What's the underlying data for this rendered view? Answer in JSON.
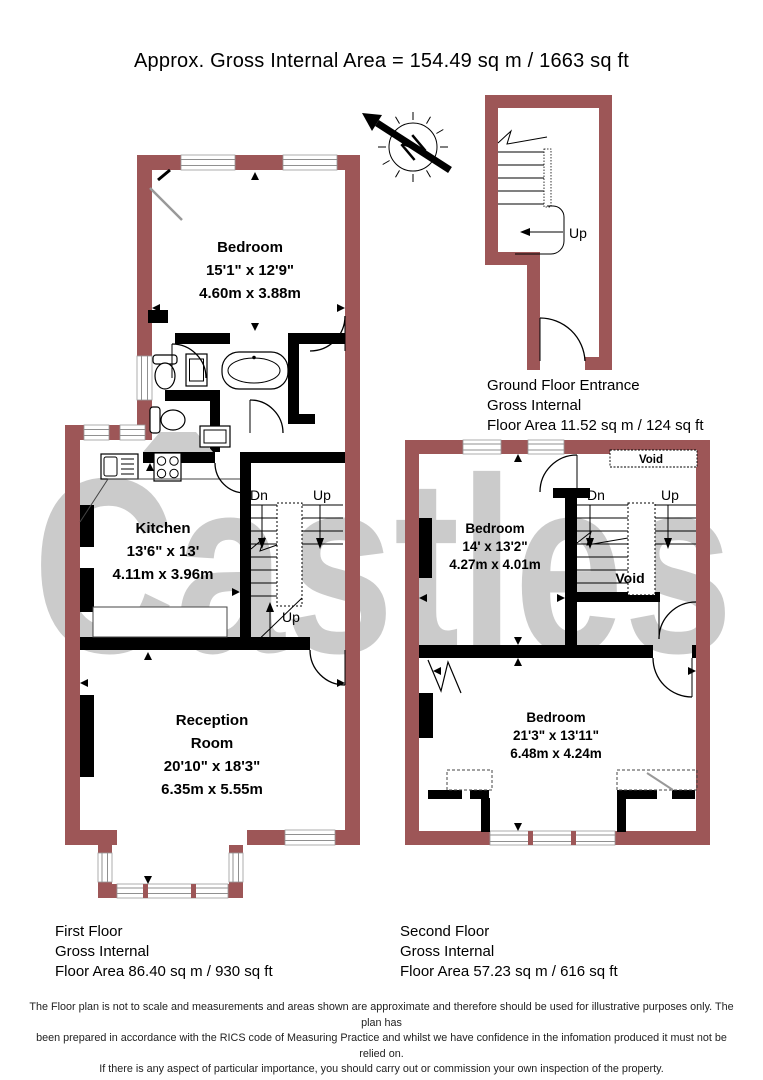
{
  "title": "Approx. Gross Internal Area = 154.49 sq m / 1663 sq ft",
  "watermark": "Castles",
  "compass": {
    "label": "N"
  },
  "colors": {
    "wall": "#9d5657",
    "interior_wall": "#000000",
    "watermark": "#cbcbcb"
  },
  "first_floor": {
    "label": {
      "line1": "First Floor",
      "line2": "Gross Internal",
      "line3": "Floor Area 86.40 sq m / 930 sq ft"
    },
    "bedroom": {
      "name": "Bedroom",
      "imperial": "15'1\" x 12'9\"",
      "metric": "4.60m x 3.88m"
    },
    "kitchen": {
      "name": "Kitchen",
      "imperial": "13'6\" x 13'",
      "metric": "4.11m x 3.96m"
    },
    "reception": {
      "name_line1": "Reception",
      "name_line2": "Room",
      "imperial": "20'10\" x 18'3\"",
      "metric": "6.35m x 5.55m"
    },
    "stairs": {
      "down": "Dn",
      "up": "Up",
      "up_lower": "Up"
    }
  },
  "ground_floor": {
    "label": {
      "line1": "Ground Floor Entrance",
      "line2": "Gross Internal",
      "line3": "Floor Area 11.52 sq m / 124 sq ft"
    },
    "stairs": {
      "up": "Up"
    }
  },
  "second_floor": {
    "label": {
      "line1": "Second Floor",
      "line2": "Gross Internal",
      "line3": "Floor Area 57.23 sq m / 616 sq ft"
    },
    "bedroom_front": {
      "name": "Bedroom",
      "imperial": "14' x 13'2\"",
      "metric": "4.27m x 4.01m"
    },
    "bedroom_back": {
      "name": "Bedroom",
      "imperial": "21'3\" x 13'11\"",
      "metric": "6.48m x 4.24m"
    },
    "stairs": {
      "down": "Dn",
      "up": "Up"
    },
    "void_top": "Void",
    "void_stair": "Void"
  },
  "disclaimer": {
    "line1": "The Floor plan is not to scale and measurements and areas shown are approximate and therefore should be used for illustrative purposes only. The plan has",
    "line2": "been prepared in accordance with the RICS code of Measuring Practice and whilst we have confidence in the infomation produced it must not be relied on.",
    "line3": "If there is any aspect of particular importance, you should carry out or commission your own inspection of the property."
  }
}
